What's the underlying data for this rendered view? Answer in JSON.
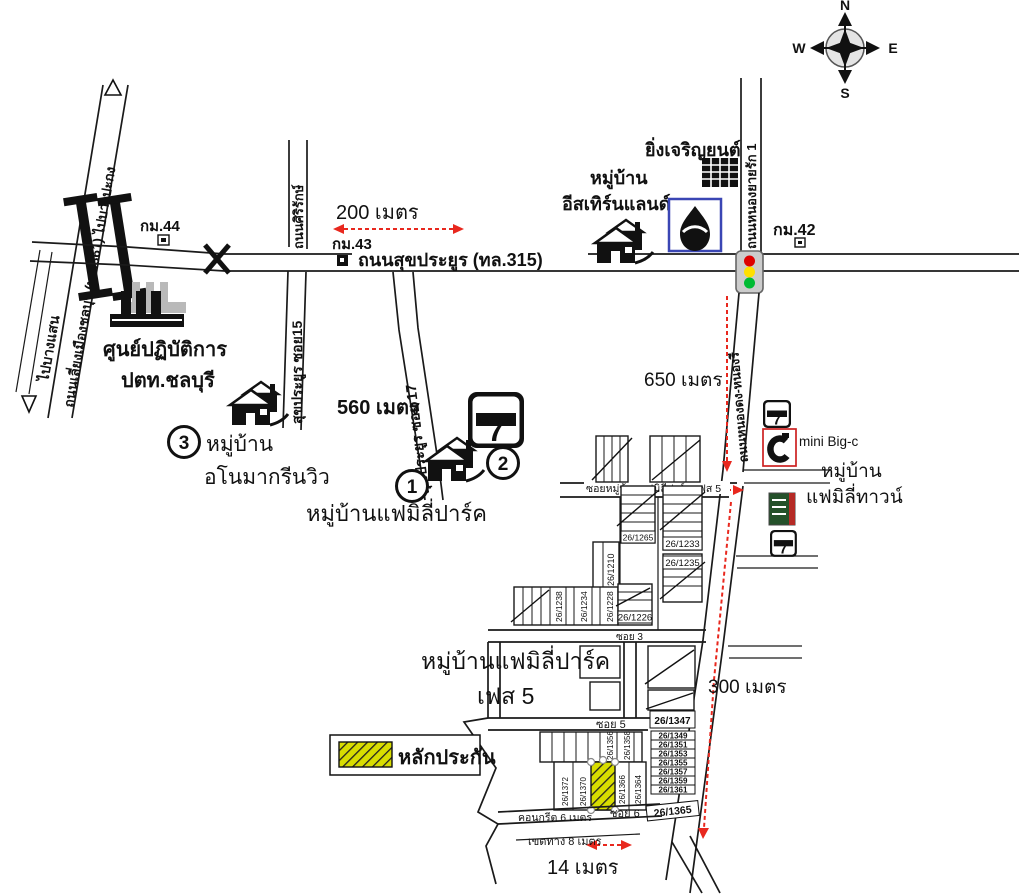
{
  "compass": {
    "n": "N",
    "e": "E",
    "s": "S",
    "w": "W"
  },
  "roads": {
    "bypass": "ถนนเลี่ยงเมืองชลบุรี (ทล.361) ไปบางปะกง",
    "to_bangsaen": "ไปบางแสน",
    "sukprayoon": "ถนนสุขประยูร (ทล.315)",
    "sirirak": "ถนนศิริรักษ์",
    "sukprayoon_soi15": "สุขประยูร ซอย15",
    "sukprayoon_soi17": "สุขประยูร ซอย 17",
    "nong_yai_rak1": "ถนนหนองยายรัก 1",
    "nong_dong_nong_ri": "ถนนหนองดง-หนองรี",
    "family_park_soi": "ซอยหมู่บ้านแฟมิลี่ปาร์ค เฟส 5",
    "soi3": "ซอย 3",
    "soi5": "ซอย 5",
    "soi6": "ซอย 6",
    "concrete6m": "คอนกรีต 6 เมตร",
    "rightofway8m": "เขตทาง 8 เมตร"
  },
  "km_markers": {
    "km44": "กม.44",
    "km43": "กม.43",
    "km42": "กม.42"
  },
  "distances": {
    "m200": "200 เมตร",
    "m560": "560 เมตร",
    "m650": "650 เมตร",
    "m300": "300 เมตร",
    "m14": "14 เมตร"
  },
  "places": {
    "ptt_center": {
      "line1": "ศูนย์ปฏิบัติการ",
      "line2": "ปตท.ชลบุรี"
    },
    "anoma": {
      "number": "3",
      "line1": "หมู่บ้าน",
      "line2": "อโนมากรีนวิว"
    },
    "family_park": {
      "number1": "1",
      "number2": "2",
      "name": "หมู่บ้านแฟมิลี่ปาร์ค"
    },
    "eastern_land": {
      "line1": "หมู่บ้าน",
      "line2": "อีสเทิร์นแลนด์"
    },
    "ying_charoen_yon": "ยิ่งเจริญยนต์",
    "mini_bigc": "mini Big-c",
    "family_town": {
      "line1": "หมู่บ้าน",
      "line2": "แฟมิลี่ทาวน์"
    },
    "family_park_phase5": {
      "line1": "หมู่บ้านแฟมิลี่ปาร์ค",
      "line2": "เฟส 5"
    }
  },
  "brands": {
    "seven": "7",
    "eleven": "ELEVEN"
  },
  "legend": {
    "collateral": "หลักประกัน"
  },
  "plots": {
    "p1265": "26/1265",
    "p1233": "26/1233",
    "p1235": "26/1235",
    "p1210": "26/1210",
    "p1238": "26/1238",
    "p1234": "26/1234",
    "p1228": "26/1228",
    "p1226": "26/1226",
    "p1356": "26/1356",
    "p1358": "26/1358",
    "p1372": "26/1372",
    "p1370": "26/1370",
    "p1366": "26/1366",
    "p1364": "26/1364",
    "p1347": "26/1347",
    "p1349": "26/1349",
    "p1351": "26/1351",
    "p1353": "26/1353",
    "p1355": "26/1355",
    "p1357": "26/1357",
    "p1359": "26/1359",
    "p1361": "26/1361",
    "p1365": "26/1365"
  },
  "colors": {
    "route_red": "#e8281e",
    "collateral_yellow": "#d8dd00",
    "ptt_blue": "#3a46b4",
    "bigc_red": "#cc2222",
    "traffic_red": "#dd0000",
    "traffic_yellow": "#ffe000",
    "traffic_green": "#00bb33",
    "lotus_green": "#24512a",
    "lotus_red": "#b52a25"
  }
}
